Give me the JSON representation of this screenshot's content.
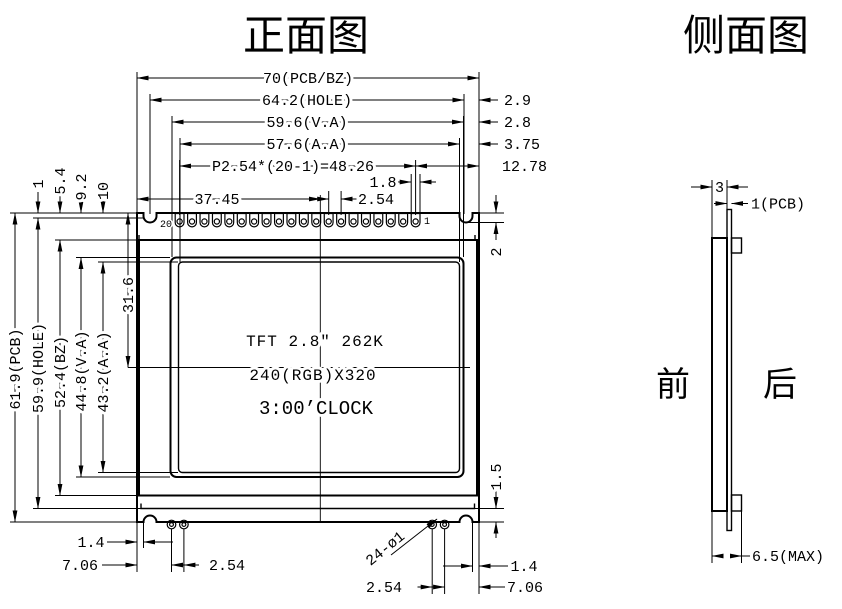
{
  "front": {
    "title": "正面图",
    "top_dims": {
      "pcb_w": "70(PCB/BZ)",
      "hole_w": "64.2(HOLE)",
      "va_w": "59.6(V.A)",
      "aa_w": "57.6(A.A)",
      "pin_span": "P2.54*(20-1)=48.26",
      "pad_w": "1.8",
      "pin_pitch": "2.54",
      "va_center_x": "37.45"
    },
    "right_dims": {
      "hole_edge": "2.9",
      "va_edge": "2.8",
      "aa_edge": "3.75",
      "pin1_edge": "12.78",
      "notch_depth": "2",
      "step_edge": "1.5"
    },
    "left_dims": {
      "pcb_h": "61.9(PCB)",
      "hole_h": "59.9(HOLE)",
      "bz_h": "52.4(BZ)",
      "va_h": "44.8(V.A)",
      "aa_h": "43.2(A.A)",
      "va_center_y": "31.6",
      "pad_offset": "1",
      "bz_offset": "5.4",
      "va_offset": "9.2",
      "aa_offset": "10"
    },
    "bottom_dims": {
      "left_notch": "1.4",
      "left_hole": "7.06",
      "left_pitch": "2.54",
      "right_notch": "1.4",
      "right_hole": "7.06",
      "right_pitch": "2.54",
      "hole_callout": "24-ø1"
    },
    "display": {
      "line1": "TFT 2.8″ 262K",
      "line2": "240(RGB)X320",
      "line3": "3:00’CLOCK"
    },
    "pins": {
      "count": 20,
      "first_label": "1",
      "last_label": "20"
    }
  },
  "side": {
    "title": "侧面图",
    "dims": {
      "total_thickness": "3",
      "pcb_thickness": "1(PCB)",
      "max_thickness": "6.5(MAX)"
    },
    "labels": {
      "front": "前",
      "back": "后"
    }
  }
}
